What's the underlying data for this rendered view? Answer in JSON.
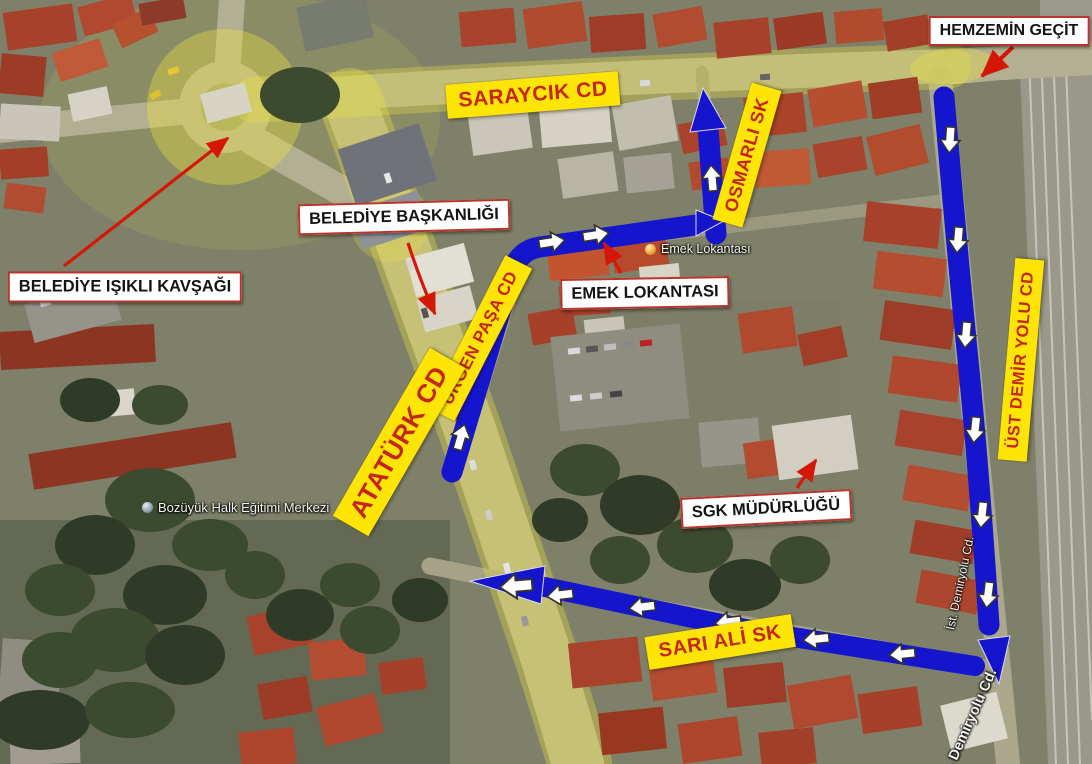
{
  "street_labels": {
    "saraycik": "SARAYCIK CD",
    "osmarli": "OSMARLI SK",
    "urgen_pasa": "ÜRGEN PAŞA CD",
    "ataturk": "ATATÜRK CD",
    "ust_demiryolu": "ÜST DEMİR YOLU CD",
    "sari_ali": "SARI ALİ SK"
  },
  "callouts": {
    "hemzemin": "HEMZEMİN GEÇİT",
    "belediye_baskanligi": "BELEDİYE BAŞKANLIĞI",
    "belediye_isikli": "BELEDİYE IŞIKLI KAVŞAĞI",
    "emek_lokantasi": "EMEK LOKANTASI",
    "sgk": "SGK MÜDÜRLÜĞÜ"
  },
  "map_pois": {
    "bozuyuk_halk": "Bozüyük Halk Eğitimi Merkezi",
    "emek_lokantasi_poi": "Emek Lokantası",
    "ist_demiryolu": "İst. Demiryolu Cd.",
    "ist_demiryolu_2": "İst. Demiryolu Cd."
  },
  "colors": {
    "route_blue": "#1515cd",
    "street_label_bg": "#ffe506",
    "street_label_text": "#c5261a",
    "callout_bg": "#ffffff",
    "callout_border": "#b9352b",
    "callout_text": "#141414",
    "pointer_red": "#d5170a",
    "direction_arrow": "#ffffff"
  }
}
